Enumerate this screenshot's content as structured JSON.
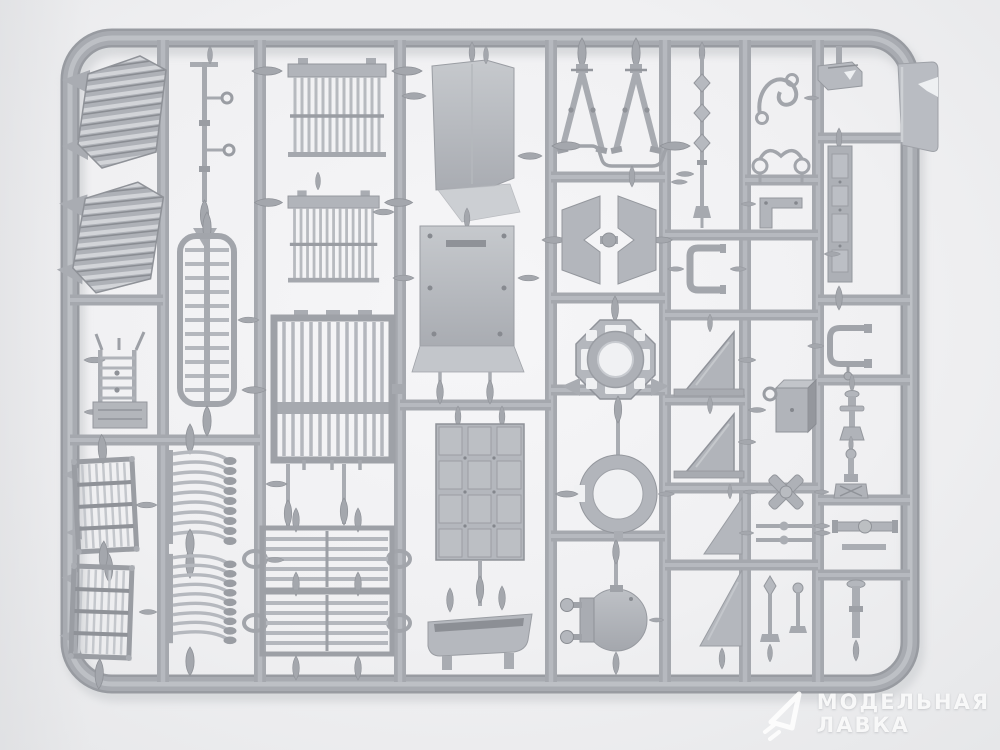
{
  "scene": {
    "subject": "gray injection-molded plastic model-kit sprue with unassembled scale-model parts on a light studio background",
    "plastic_color": "#a8abb1",
    "plastic_highlight": "#c6c9cd",
    "plastic_shadow": "#8f9298",
    "background_color": "#efeff1"
  },
  "watermark": {
    "logo_icon": "paper-plane-triangle-icon",
    "line1": "МОДЕЛЬНАЯ",
    "line2": "ЛАВКА",
    "text_color": "#ffffff"
  },
  "sprue": {
    "frame_shape": "rounded-rectangle",
    "tab": "corner-label-tab",
    "parts": [
      "ribbed-fender",
      "ribbed-fender",
      "ladder-frame",
      "slat-basket-grille",
      "slat-basket-grille",
      "linkage-rod",
      "oval-radiator-grille",
      "hook-slat-grille",
      "hook-slat-grille",
      "slatted-vent-panel",
      "slatted-vent-panel",
      "barred-grate",
      "slatted-deck-grate",
      "slatted-deck-grate",
      "hull-side-panel",
      "bolted-hull-panel",
      "engine-deck-panel",
      "stowage-trough",
      "a-frame-support",
      "a-frame-support",
      "tow-bar",
      "notched-bracket-pair",
      "octagonal-turret-ring",
      "circular-hatch-ring",
      "round-hatch-lid",
      "beaded-antenna-rod",
      "u-channel-bracket",
      "triangular-gusset",
      "triangular-gusset",
      "wedge-plate",
      "wedge-plate",
      "wire-clip",
      "looped-wire",
      "l-bracket",
      "stowage-box",
      "x-rotor-fitting",
      "rod-pair",
      "pin-fittings",
      "corner-bracket",
      "detail-strip",
      "c-clamp",
      "turned-pin",
      "turned-pin",
      "bar-fitting",
      "pin-post"
    ]
  }
}
